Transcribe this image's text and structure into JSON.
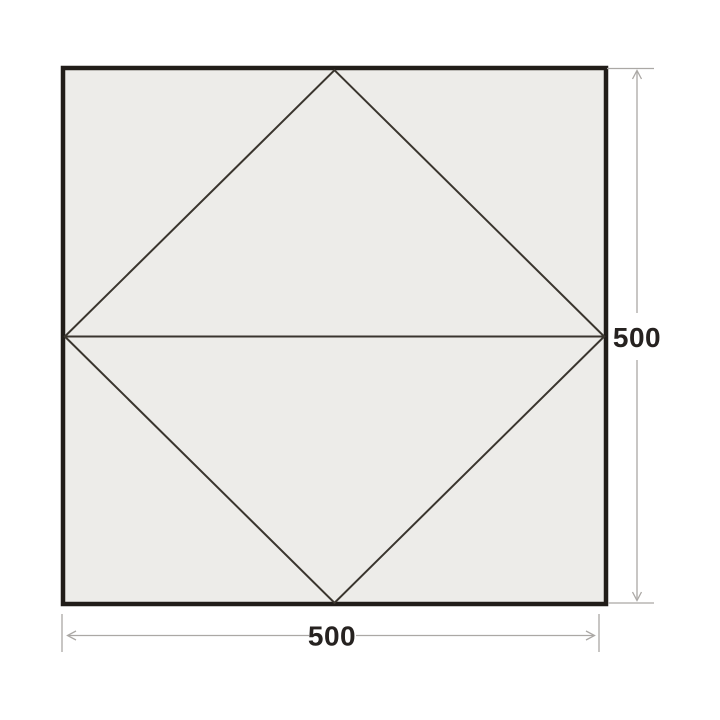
{
  "diagram": {
    "width_label": "500",
    "height_label": "500"
  },
  "colors": {
    "page-bg": "#ffffff",
    "tarp-fill": "#edece9",
    "tarp-outline": "#211d19",
    "fold-line": "#3a352e",
    "dimension-line": "#aba8a5",
    "dimension-text": "#262220"
  }
}
